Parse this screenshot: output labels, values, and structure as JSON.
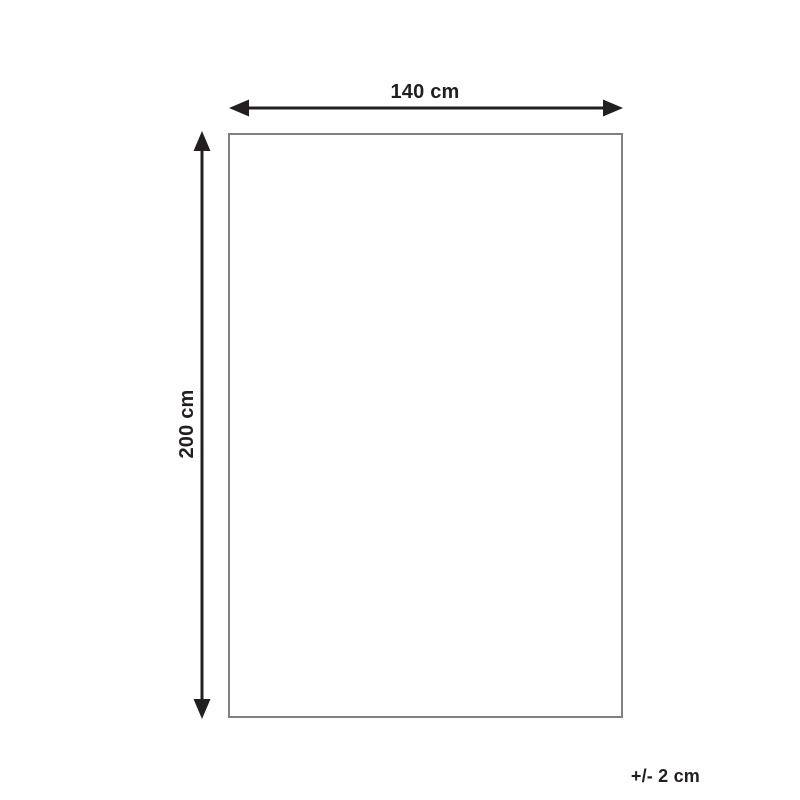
{
  "diagram": {
    "title": "product-dimension-diagram",
    "width_label": "140 cm",
    "height_label": "200 cm",
    "tolerance_label": "+/- 2 cm",
    "colors": {
      "arrow": "#231f20",
      "rectangle_border": "#808080",
      "background": "#ffffff"
    }
  }
}
